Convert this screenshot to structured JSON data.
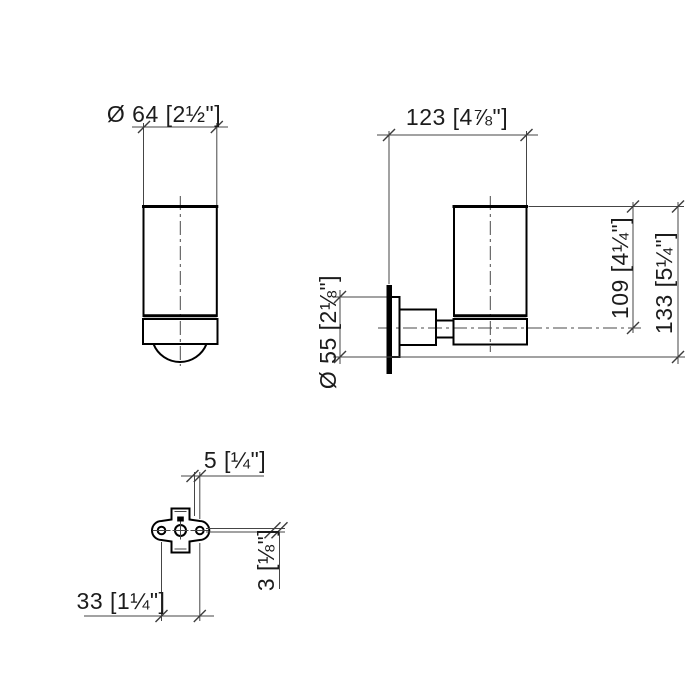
{
  "drawing": {
    "type": "technical-dimension-drawing",
    "views": {
      "front": "glass-tumbler-front-view",
      "side": "wall-mounted-holder-side-view",
      "plate": "mounting-plate-view"
    },
    "dimensions": {
      "glass_diameter": "Ø 64 [2½\"]",
      "depth": "123 [4⅞\"]",
      "height_to_axis": "109 [4¼\"]",
      "overall_height": "133 [5¼\"]",
      "rosette_diameter": "Ø 55 [2⅛\"]",
      "top_offset": "5 [¼\"]",
      "side_offset": "3 [⅛\"]",
      "hole_spacing": "33 [1¼\"]"
    }
  }
}
